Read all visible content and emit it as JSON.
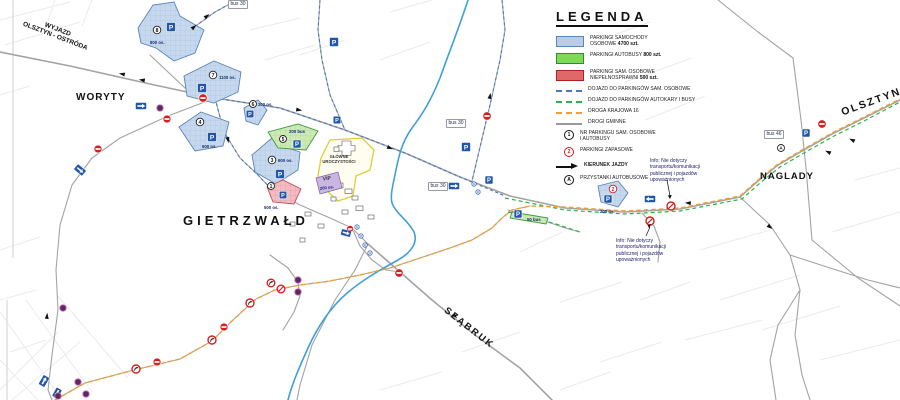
{
  "legend": {
    "title": "LEGENDA",
    "items": [
      {
        "label": "PARKINGI SAMOCHODY\nOSOBOWE",
        "count": "4700 szt."
      },
      {
        "label": "PARKINGI AUTOBUSY",
        "count": "800 szt."
      },
      {
        "label": "PARKINGI SAM. OSOBOWE\nNIEPEŁNOSPRAWNI",
        "count": "500 szt."
      },
      {
        "label": "DOJAZD DO PARKINGÓW SAM. OSOBOWE",
        "count": ""
      },
      {
        "label": "DOJAZD DO PARKINGÓW AUTOKARY I BUSY",
        "count": ""
      },
      {
        "label": "DROGA KRAJOWA 16",
        "count": ""
      },
      {
        "label": "DROGI GMINNE",
        "count": ""
      },
      {
        "label": "NR PARKINGU SAM. OSOBOWE\nI AUTOBUSY",
        "count": "",
        "symbol": "1"
      },
      {
        "label": "PARKINGI ZAPASOWE",
        "count": "",
        "symbol": "2"
      },
      {
        "label": "KIERUNEK JAZDY",
        "count": ""
      },
      {
        "label": "PRZYSTANKI AUTOBUSOWE",
        "count": "",
        "symbol": "A"
      }
    ]
  },
  "places": {
    "exit_label": "WYJAZD\nOLSZTYN - OSTRÓDA",
    "woryty": "WORYTY",
    "gietrzwald": "GIETRZWAŁD",
    "szabruk": "SZĄBRUK",
    "naglady": "NAGLADY",
    "olsztyn": "OLSZTYN"
  },
  "sanctuary": {
    "label": "GŁÓWNE\nUROCZYSTOŚCI",
    "vip": "VIP",
    "vip_capacity": "200 os."
  },
  "parkings": [
    {
      "num": "8",
      "capacity": "800 os."
    },
    {
      "num": "7",
      "capacity": "1100 os."
    },
    {
      "num": "4",
      "capacity": "600 os."
    },
    {
      "num": "6",
      "capacity": "200 os."
    },
    {
      "num": "3",
      "capacity": "600 os."
    },
    {
      "num": "5",
      "capacity": "200 bus"
    },
    {
      "num": "2",
      "capacity": "200 os."
    },
    {
      "num": "",
      "capacity": "50 bus"
    },
    {
      "num": "1",
      "capacity": "500 os."
    }
  ],
  "route_labels": [
    {
      "text": "bus 30"
    },
    {
      "text": "bus 30"
    },
    {
      "text": "bus 30"
    },
    {
      "text": "bus 46"
    }
  ],
  "notes": {
    "info": "Info: Nie dotyczy\ntransportu/komunikacji\npublicznej i pojazdów\nupoważnionych"
  },
  "icons": {
    "p": "P",
    "bus_stop": "A"
  },
  "colors": {
    "parking_car": "#b9cde8",
    "parking_bus": "#7ed957",
    "parking_disabled": "#e06868",
    "route_national": "#f0a030",
    "route_bus_access": "#2eb24c",
    "route_car_access": "#4a78c0",
    "road": "#a3a3a3",
    "river": "#3fa0d8",
    "sign_blue": "#2257a5",
    "sign_red": "#d42020"
  }
}
